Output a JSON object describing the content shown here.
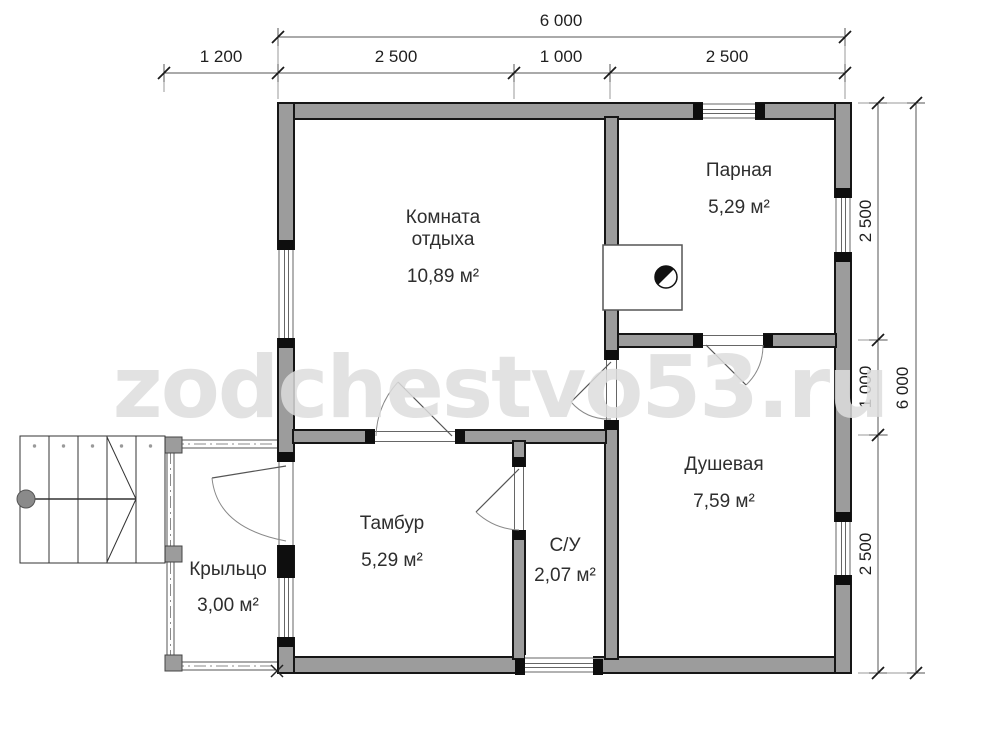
{
  "watermark": "zodchestvo53.ru",
  "plan": {
    "rooms": [
      {
        "name": "Комната отдыха",
        "area": "10,89 м²"
      },
      {
        "name": "Парная",
        "area": "5,29 м²"
      },
      {
        "name": "Душевая",
        "area": "7,59 м²"
      },
      {
        "name": "Тамбур",
        "area": "5,29 м²"
      },
      {
        "name": "С/У",
        "area": "2,07 м²"
      },
      {
        "name": "Крыльцо",
        "area": "3,00 м²"
      }
    ],
    "dimensions": {
      "top_total": "6 000",
      "top_segments": [
        "1 200",
        "2 500",
        "1 000",
        "2 500"
      ],
      "right_total": "6 000",
      "right_segments": [
        "2 500",
        "1 000",
        "2 500"
      ]
    },
    "colors": {
      "wall_fill": "#9c9c9c",
      "wall_outline": "#161616",
      "dim_line": "#555555",
      "watermark": "#dddddd"
    }
  }
}
